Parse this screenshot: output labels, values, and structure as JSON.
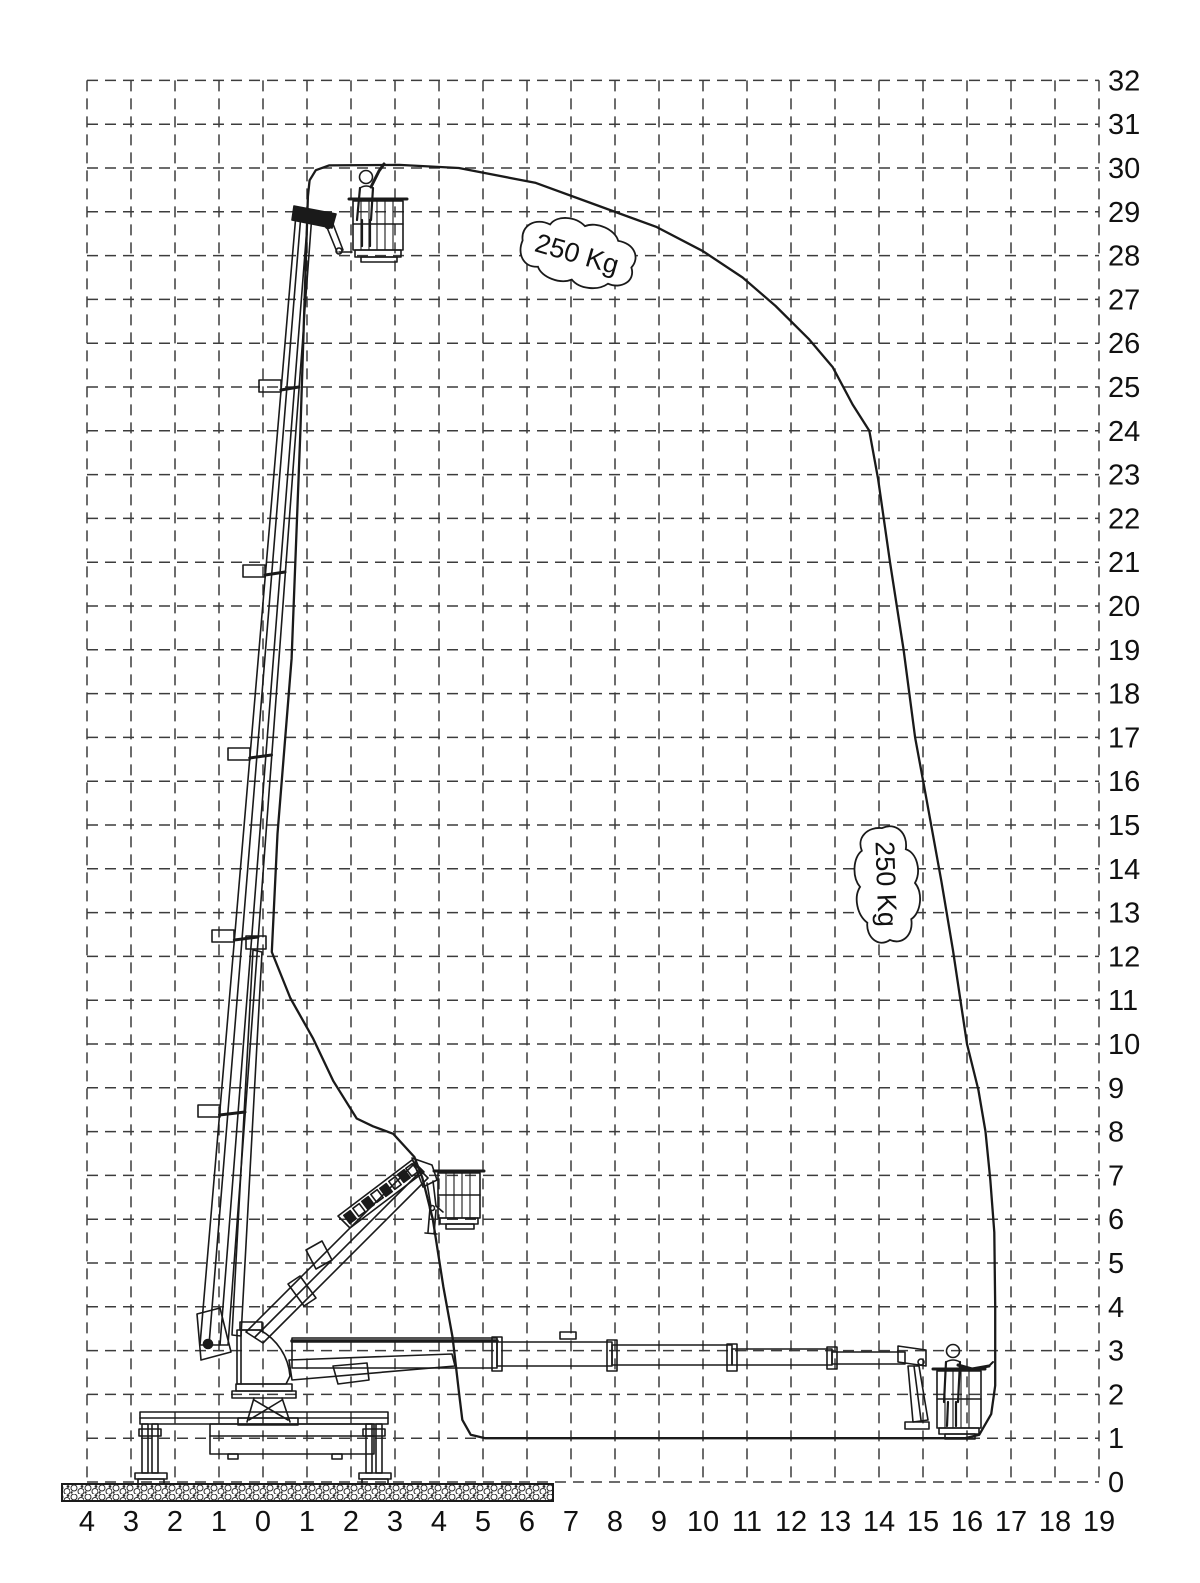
{
  "axes": {
    "x": {
      "min": -4,
      "max": 19,
      "tick_labels": [
        "4",
        "3",
        "2",
        "1",
        "0",
        "1",
        "2",
        "3",
        "4",
        "5",
        "6",
        "7",
        "8",
        "9",
        "10",
        "11",
        "12",
        "13",
        "14",
        "15",
        "16",
        "17",
        "18",
        "19"
      ]
    },
    "y": {
      "min": 0,
      "max": 32,
      "tick_labels": [
        "0",
        "1",
        "2",
        "3",
        "4",
        "5",
        "6",
        "7",
        "8",
        "9",
        "10",
        "11",
        "12",
        "13",
        "14",
        "15",
        "16",
        "17",
        "18",
        "19",
        "20",
        "21",
        "22",
        "23",
        "24",
        "25",
        "26",
        "27",
        "28",
        "29",
        "30",
        "31",
        "32"
      ]
    }
  },
  "load_labels": {
    "top": "250 Kg",
    "right": "250 Kg"
  },
  "colors": {
    "background": "#ffffff",
    "line": "#1a1a1a",
    "grid": "#3c3c3c"
  },
  "chart_data": {
    "type": "area",
    "title": "",
    "xlabel": "",
    "ylabel": "",
    "x_range": [
      -4,
      19
    ],
    "y_range": [
      0,
      32
    ],
    "grid": "dashed 1 m squares",
    "annotations": [
      "250 Kg",
      "250 Kg"
    ],
    "max_working_height_m": 30,
    "max_outreach_m": 16.6,
    "envelope_outline_m": [
      [
        1.02,
        29.35
      ],
      [
        1.06,
        29.72
      ],
      [
        1.2,
        29.95
      ],
      [
        1.5,
        30.06
      ],
      [
        3.1,
        30.07
      ],
      [
        4.45,
        30.0
      ],
      [
        6.2,
        29.66
      ],
      [
        7.45,
        29.2
      ],
      [
        8.95,
        28.65
      ],
      [
        10.0,
        28.1
      ],
      [
        10.9,
        27.5
      ],
      [
        11.65,
        26.85
      ],
      [
        12.4,
        26.1
      ],
      [
        12.95,
        25.45
      ],
      [
        13.4,
        24.6
      ],
      [
        13.78,
        24.0
      ],
      [
        13.98,
        22.9
      ],
      [
        14.25,
        21.0
      ],
      [
        14.56,
        19.0
      ],
      [
        14.82,
        17.0
      ],
      [
        15.06,
        15.7
      ],
      [
        15.42,
        13.7
      ],
      [
        15.68,
        12.15
      ],
      [
        16.0,
        10.0
      ],
      [
        16.26,
        8.95
      ],
      [
        16.42,
        8.0
      ],
      [
        16.53,
        6.9
      ],
      [
        16.62,
        5.7
      ],
      [
        16.64,
        4.0
      ],
      [
        16.64,
        2.2
      ],
      [
        16.55,
        1.55
      ],
      [
        16.28,
        1.08
      ],
      [
        15.95,
        1.0
      ],
      [
        5.05,
        1.0
      ],
      [
        4.72,
        1.08
      ],
      [
        4.53,
        1.42
      ],
      [
        4.46,
        2.0
      ],
      [
        4.31,
        3.3
      ],
      [
        4.1,
        4.45
      ],
      [
        3.86,
        6.0
      ],
      [
        3.62,
        6.95
      ],
      [
        3.44,
        7.42
      ],
      [
        2.96,
        7.95
      ],
      [
        2.5,
        8.12
      ],
      [
        2.13,
        8.3
      ],
      [
        1.6,
        9.15
      ],
      [
        1.14,
        10.12
      ],
      [
        0.62,
        11.05
      ],
      [
        0.2,
        12.1
      ],
      [
        0.33,
        14.8
      ],
      [
        0.65,
        18.8
      ],
      [
        0.85,
        24.0
      ],
      [
        1.02,
        29.35
      ]
    ]
  }
}
